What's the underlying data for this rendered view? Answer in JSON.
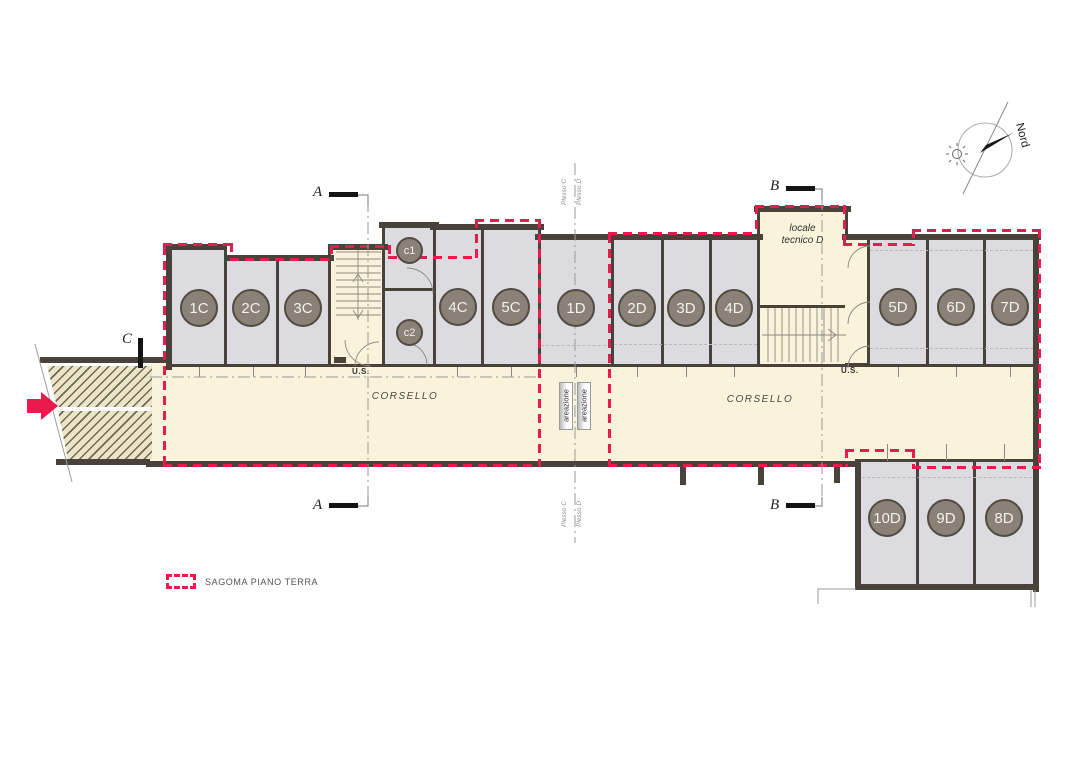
{
  "drawing": {
    "type": "basement garage floor plan",
    "north_label": "Nord",
    "legend": {
      "label": "SAGOMA PIANO TERRA",
      "swatch_style": "red dashed outline"
    },
    "corridor": {
      "label": "CORSELLO"
    },
    "ventilation": {
      "label": "areazione"
    },
    "exit": {
      "label": "U.S."
    },
    "technical_room": {
      "line1": "locale",
      "line2": "tecnico D"
    },
    "axis_labels": {
      "plesso_c": "Plesso C",
      "plesso_d": "Plesso D"
    },
    "sections": {
      "a": "A",
      "b": "B",
      "c": "C"
    }
  },
  "garages": [
    {
      "label": "1C"
    },
    {
      "label": "2C"
    },
    {
      "label": "3C"
    },
    {
      "label": "4C"
    },
    {
      "label": "5C"
    },
    {
      "label": "1D"
    },
    {
      "label": "2D"
    },
    {
      "label": "3D"
    },
    {
      "label": "4D"
    },
    {
      "label": "5D"
    },
    {
      "label": "6D"
    },
    {
      "label": "7D"
    },
    {
      "label": "8D"
    },
    {
      "label": "9D"
    },
    {
      "label": "10D"
    }
  ],
  "small_rooms": [
    {
      "label": "c1"
    },
    {
      "label": "c2"
    }
  ],
  "colors": {
    "sagoma_red": "#ea1a4d",
    "arrow_red": "#ea1a4d",
    "wall_dark": "#49423a",
    "garage_fill": "#dcdce0",
    "corridor_fill": "#f8f3da",
    "badge_fill": "#8a8177"
  }
}
